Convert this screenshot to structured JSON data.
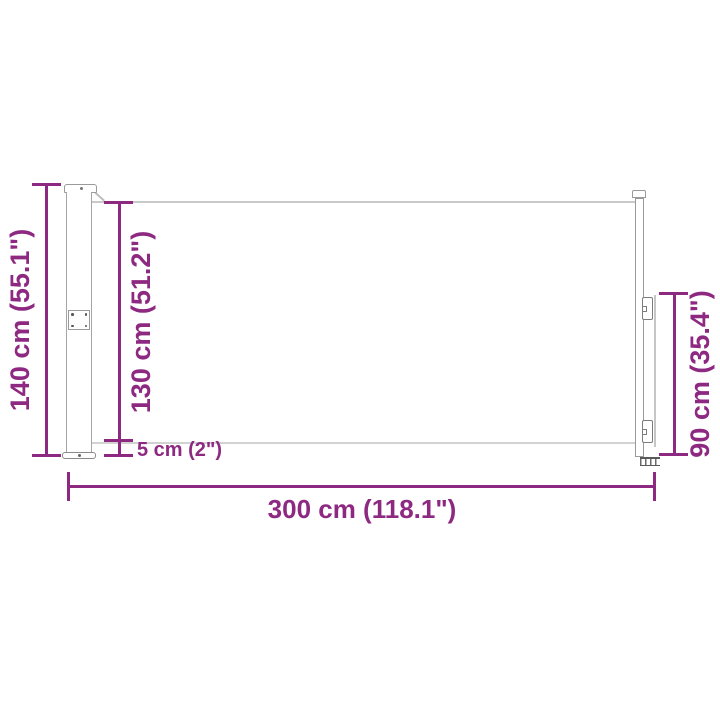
{
  "diagram": {
    "type": "product-dimension-diagram",
    "subject": "retractable side awning, extended, side view",
    "accent_color": "#8E2981",
    "outline_color": "#9a9a9a",
    "fabric_edge_color": "#c9c9c9",
    "background_color": "#ffffff",
    "dimensions": {
      "total_height": {
        "label": "140 cm (55.1\")",
        "measures": "cassette post total height"
      },
      "fabric_height": {
        "label": "130 cm (51.2\")",
        "measures": "fabric panel height"
      },
      "ground_clearance": {
        "label": "5 cm (2\")",
        "measures": "gap below fabric"
      },
      "end_height": {
        "label": "90 cm (35.4\")",
        "measures": "front bar handle height"
      },
      "total_width": {
        "label": "300 cm (118.1\")",
        "measures": "extension length"
      }
    }
  }
}
